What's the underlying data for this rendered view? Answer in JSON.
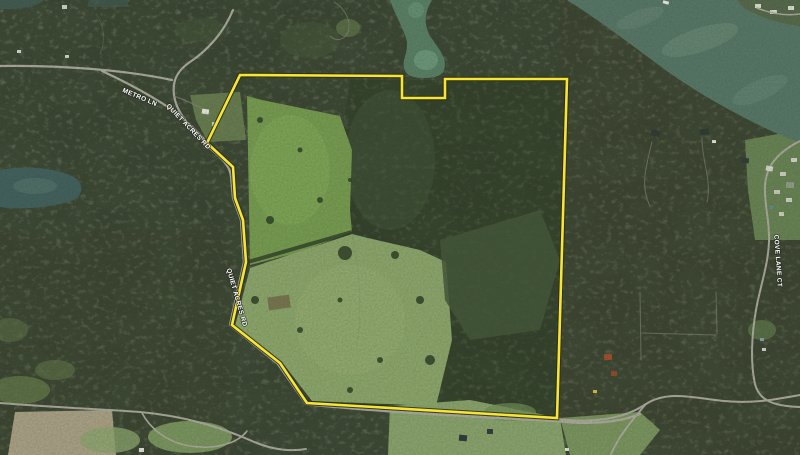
{
  "map": {
    "type": "satellite-aerial-view",
    "labels": [
      {
        "id": "metro-ln",
        "text": "METRO LN",
        "x": 139,
        "y": 99,
        "rotate": 23
      },
      {
        "id": "quiet-acres-rd-upper",
        "text": "QUIET ACRES RD",
        "x": 187,
        "y": 128,
        "rotate": 46
      },
      {
        "id": "quiet-acres-rd-lower",
        "text": "QUIET ACRES RD",
        "x": 235,
        "y": 298,
        "rotate": 74
      },
      {
        "id": "cove-lane-ct",
        "text": "COVE LANE CT",
        "x": 776,
        "y": 261,
        "rotate": 86
      }
    ],
    "boundary": {
      "color": "#f6e534",
      "casing_color": "#2b2b15",
      "points": "207,143 240,75 402,76 402,98 445,98 445,79 567,79 557,418 307,403 280,363 232,325 246,262 243,220 235,198 233,167"
    },
    "colors": {
      "forest_base": "#3a4431",
      "water_lake": "#567565",
      "water_inlet": "#587e62",
      "water_pond": "#42605c",
      "field_upper": "#75994f",
      "field_lower": "#8aa369",
      "road": "#a7a799",
      "label_text": "#ffffff",
      "label_halo": "#20241c"
    }
  }
}
